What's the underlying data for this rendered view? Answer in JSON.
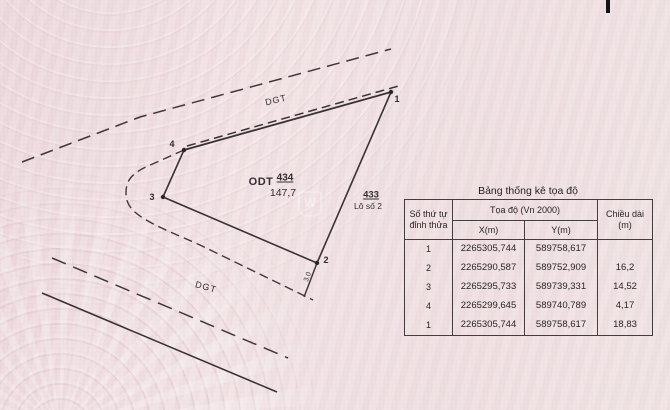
{
  "document": {
    "kind": "cadastral-extract",
    "background_color": "#eedfe1",
    "line_color": "#413639"
  },
  "watermark": {
    "letter": "W"
  },
  "diagram": {
    "road_label_top": "DGT",
    "road_label_bottom": "DGT",
    "parcel_code": "ODT",
    "parcel_number": "434",
    "parcel_area": "147,7",
    "neighbor_number": "433",
    "neighbor_label": "Lô số 2",
    "offset_dim": "3.0",
    "vertex_labels": {
      "v1": "1",
      "v2": "2",
      "v3": "3",
      "v4": "4"
    }
  },
  "table": {
    "title": "Bảng thống kê tọa độ",
    "header": {
      "col_index": "Số thứ tự đỉnh thửa",
      "col_coords": "Tọa độ (Vn 2000)",
      "col_x": "X(m)",
      "col_y": "Y(m)",
      "col_length": "Chiều dài (m)"
    },
    "rows": [
      {
        "stt": "1",
        "x": "2265305,744",
        "y": "589758,617",
        "length": ""
      },
      {
        "stt": "2",
        "x": "2265290,587",
        "y": "589752,909",
        "length": "16,2"
      },
      {
        "stt": "3",
        "x": "2265295,733",
        "y": "589739,331",
        "length": "14,52"
      },
      {
        "stt": "4",
        "x": "2265299,645",
        "y": "589740,789",
        "length": "4,17"
      },
      {
        "stt": "1",
        "x": "2265305,744",
        "y": "589758,617",
        "length": "18,83"
      }
    ]
  }
}
